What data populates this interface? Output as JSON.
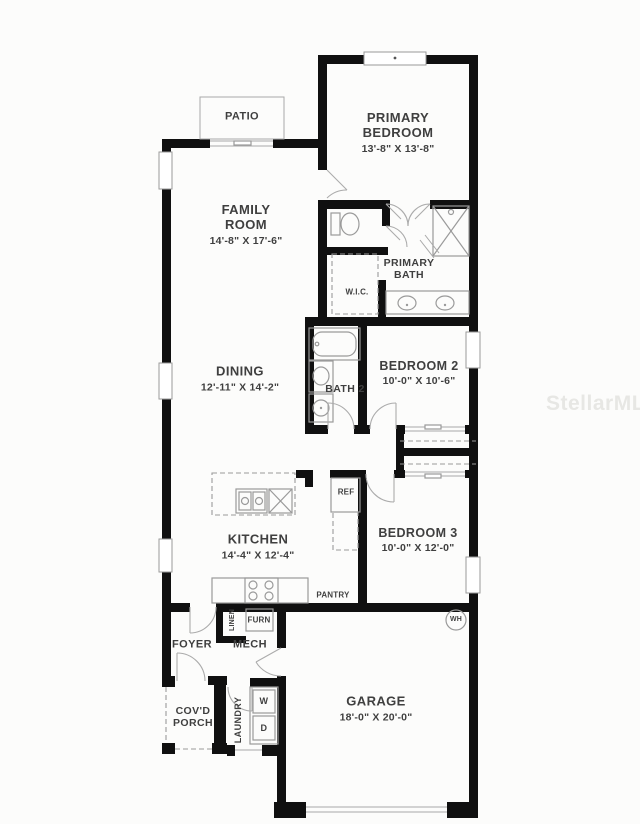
{
  "watermark": {
    "text": "StellarMLS"
  },
  "colors": {
    "background": "#fcfcfb",
    "walls": "#101010",
    "text": "#3f3f3f",
    "fixtures": "#9a9a9a",
    "watermark": "#e7e7e4"
  },
  "rooms": {
    "patio": {
      "name": "PATIO"
    },
    "primary_bedroom": {
      "name": "PRIMARY BEDROOM",
      "dims": "13'-8\" X 13'-8\""
    },
    "family_room": {
      "name": "FAMILY ROOM",
      "dims": "14'-8\" X 17'-6\""
    },
    "primary_bath": {
      "name": "PRIMARY BATH"
    },
    "wic": {
      "name": "W.I.C."
    },
    "dining": {
      "name": "DINING",
      "dims": "12'-11\" X 14'-2\""
    },
    "bath2": {
      "name": "BATH 2"
    },
    "bedroom2": {
      "name": "BEDROOM 2",
      "dims": "10'-0\" X 10'-6\""
    },
    "kitchen": {
      "name": "KITCHEN",
      "dims": "14'-4\" X 12'-4\""
    },
    "ref": {
      "name": "REF"
    },
    "bedroom3": {
      "name": "BEDROOM 3",
      "dims": "10'-0\" X 12'-0\""
    },
    "pantry": {
      "name": "PANTRY"
    },
    "linen": {
      "name": "LINEN"
    },
    "furn": {
      "name": "FURN"
    },
    "foyer": {
      "name": "FOYER"
    },
    "mech": {
      "name": "MECH"
    },
    "covd_porch": {
      "name": "COV'D PORCH"
    },
    "laundry": {
      "name": "LAUNDRY"
    },
    "washer": {
      "name": "W"
    },
    "dryer": {
      "name": "D"
    },
    "garage": {
      "name": "GARAGE",
      "dims": "18'-0\" X 20'-0\""
    },
    "water_heater": {
      "name": "WH"
    }
  }
}
